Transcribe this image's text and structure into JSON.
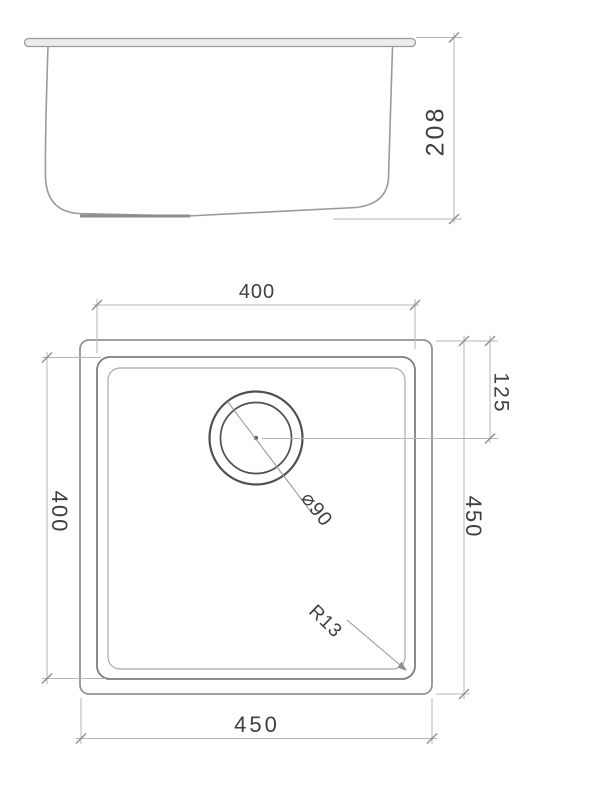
{
  "drawing": {
    "type": "technical-drawing",
    "views": {
      "side_view": "sink side elevation",
      "plan_view": "sink top plan"
    },
    "dimensions": {
      "depth": "208",
      "top_width": "400",
      "left_height": "400",
      "right_height": "450",
      "drain_offset": "125",
      "bottom_width": "450",
      "drain_diameter": "⌀90",
      "corner_radius": "R13"
    },
    "colors": {
      "background": "#ffffff",
      "linework": "#9a9a9a",
      "dimension_lines": "#b5b5b5",
      "drain_circle": "#4f4f4f",
      "text": "#3f3f3f"
    }
  }
}
